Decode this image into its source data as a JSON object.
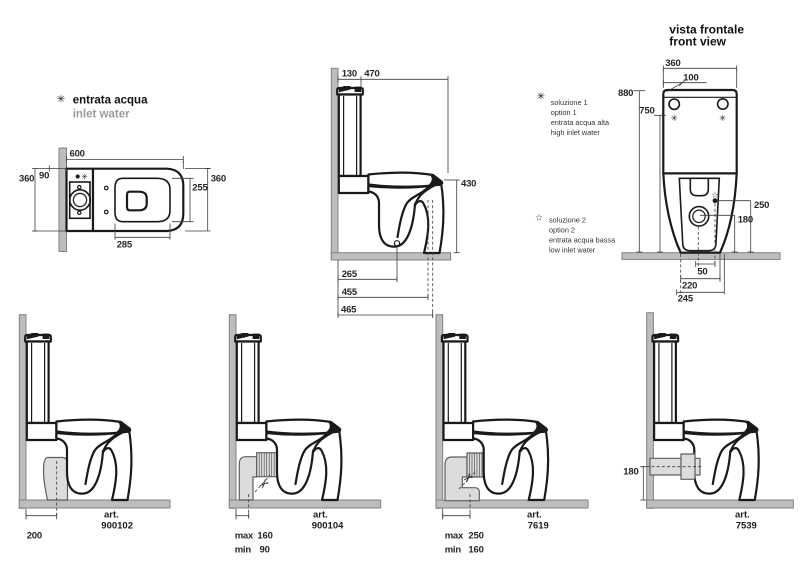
{
  "legend": {
    "symbol": "✳",
    "title": "entrata acqua",
    "subtitle": "inlet water"
  },
  "plan": {
    "d600": "600",
    "d90": "90",
    "d360_left": "360",
    "d360_right": "360",
    "d255": "255",
    "d285": "285",
    "inlet_symbol": "✳"
  },
  "side": {
    "d130": "130",
    "d470": "470",
    "d430": "430",
    "d265": "265",
    "d455": "455",
    "d465": "465"
  },
  "front": {
    "title1": "vista frontale",
    "title2": "front view",
    "d360": "360",
    "d100": "100",
    "d880": "880",
    "d750": "750",
    "d250": "250",
    "d180": "180",
    "d50": "50",
    "d220": "220",
    "d245": "245",
    "inlet_symbol_left": "✳",
    "inlet_symbol_right": "✳",
    "low_symbol": "☆"
  },
  "notes": {
    "n1": {
      "icon": "✳",
      "l1": "soluzione 1",
      "l2": "option 1",
      "l3": "entrata acqua alta",
      "l4": "high inlet water"
    },
    "n2": {
      "icon": "☆",
      "l1": "soluzione 2",
      "l2": "option 2",
      "l3": "entrata acqua bassa",
      "l4": "low inlet water"
    }
  },
  "variants": [
    {
      "art_label": "art.",
      "art_number": "900102",
      "rows": [
        {
          "label": "",
          "value": "200"
        }
      ]
    },
    {
      "art_label": "art.",
      "art_number": "900104",
      "cut": "✂",
      "rows": [
        {
          "label": "max",
          "value": "160"
        },
        {
          "label": "min",
          "value": "90"
        }
      ]
    },
    {
      "art_label": "art.",
      "art_number": "7619",
      "cut": "✂",
      "rows": [
        {
          "label": "max",
          "value": "250"
        },
        {
          "label": "min",
          "value": "160"
        }
      ]
    },
    {
      "art_label": "art.",
      "art_number": "7539",
      "rows": [
        {
          "label": "",
          "value": "180"
        }
      ]
    }
  ],
  "colors": {
    "line": "#1a1a1a",
    "wall_fill": "#bdbdbd",
    "wall_edge": "#828282",
    "pipe_fill": "#dcdcdc",
    "pipe_edge": "#5e5e5e",
    "dim_line": "#3c3c3c",
    "muted_text": "#9c9c9c"
  }
}
